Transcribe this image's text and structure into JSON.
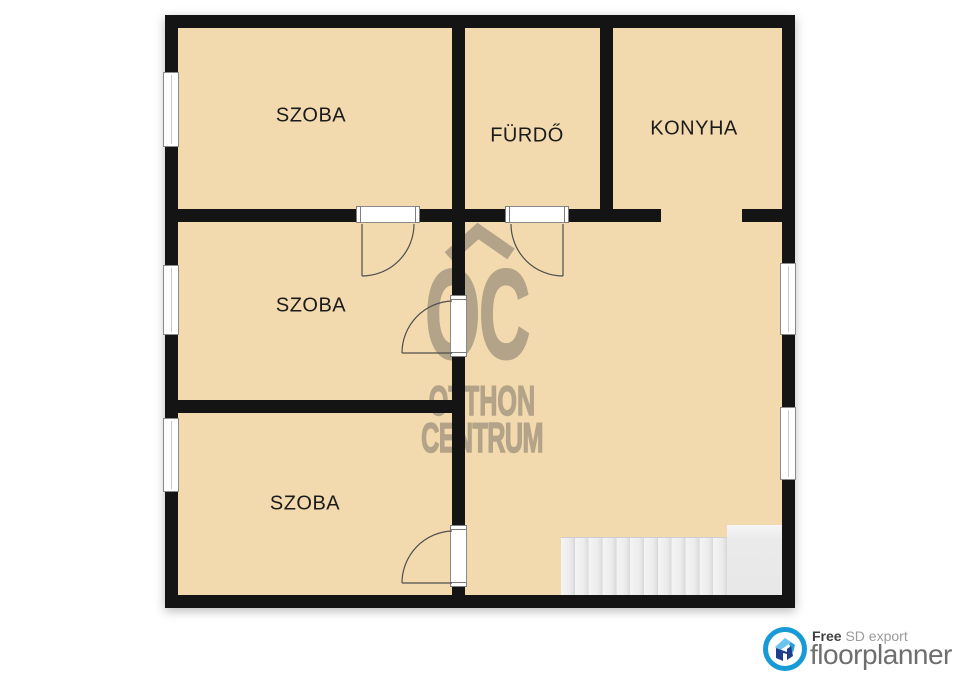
{
  "plan": {
    "rooms": [
      {
        "id": "szoba-top",
        "label": "SZOBA"
      },
      {
        "id": "furdo",
        "label": "FÜRDŐ"
      },
      {
        "id": "konyha",
        "label": "KONYHA"
      },
      {
        "id": "szoba-middle",
        "label": "SZOBA"
      },
      {
        "id": "szoba-bottom",
        "label": "SZOBA"
      }
    ],
    "windows_count": 5,
    "doors_count": 4,
    "stairs_steps": 12,
    "colors": {
      "floor": "#f2daae",
      "wall": "#141414",
      "outside": "#ffffff",
      "door_arc": "#4f4f4f",
      "stair": "#ececec"
    }
  },
  "watermark": {
    "monogram": "OC",
    "line1": "OTTHON",
    "line2": "CENTRUM",
    "color": "#b3a388"
  },
  "branding": {
    "free_label": "Free",
    "export_label": "SD export",
    "product_name": "floorplanner",
    "ring_color": "#189ad6",
    "house_dark": "#1e3d8f",
    "house_light": "#6cc4ee",
    "house_mid": "#2a9fd8"
  }
}
